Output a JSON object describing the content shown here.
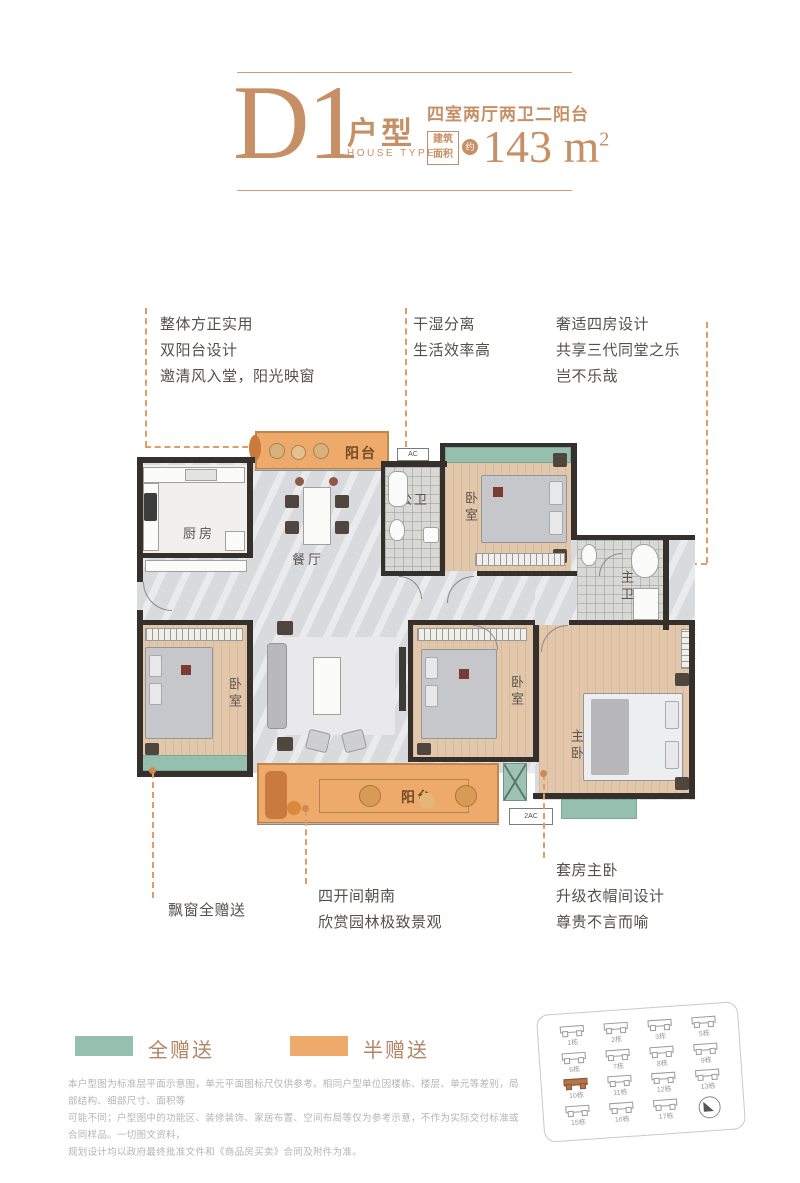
{
  "header": {
    "code": "D1",
    "type_label": "户型",
    "type_en": "HOUSE TYPE",
    "layout": "四室两厅两卫二阳台",
    "area_box_line1": "建筑",
    "area_box_line2": "面积",
    "area_circle": "约",
    "area_number": "143 m",
    "area_sup": "2",
    "accent_color": "#c68f65"
  },
  "callouts": {
    "top_left": [
      "整体方正实用",
      "双阳台设计",
      "邀清风入堂，阳光映窗"
    ],
    "top_mid": [
      "干湿分离",
      "生活效率高"
    ],
    "top_right": [
      "奢适四房设计",
      "共享三代同堂之乐",
      "岂不乐哉"
    ],
    "bottom_left": [
      "飘窗全赠送"
    ],
    "bottom_mid": [
      "四开间朝南",
      "欣赏园林极致景观"
    ],
    "bottom_right": [
      "套房主卧",
      "升级衣帽间设计",
      "尊贵不言而喻"
    ]
  },
  "rooms": {
    "kitchen": "厨房",
    "dining": "餐厅",
    "living": "客厅",
    "public_bath": "公卫",
    "master_bath": "主卫",
    "bedroom_top": "卧室",
    "bedroom_left": "卧室",
    "bedroom_mid": "卧室",
    "master_bedroom": "主卧",
    "cloakroom": "衣帽间",
    "balcony_top": "阳台",
    "balcony_bottom": "阳台",
    "ac_top": "AC",
    "ac_bottom": "2AC"
  },
  "legend": {
    "full_gift": {
      "label": "全赠送",
      "color": "#95bfae"
    },
    "half_gift": {
      "label": "半赠送",
      "color": "#edaa6b"
    }
  },
  "disclaimer": [
    "本户型图为标准层平面示意图，单元平面图标尺仅供参考。相同户型单位因楼栋、楼层、单元等差别，局部结构、细部尺寸、面积等",
    "可能不同；户型图中的功能区、装修装饰、家居布置、空间布局等仅为参考示意，不作为实际交付标准或合同样品。一切图文资料，",
    "规划设计均以政府最终批准文件和《商品房买卖》合同及附件为准。"
  ],
  "siteplan": {
    "buildings": [
      {
        "label": "1栋"
      },
      {
        "label": "2栋"
      },
      {
        "label": "3栋"
      },
      {
        "label": "5栋"
      },
      {
        "label": "6栋"
      },
      {
        "label": "7栋"
      },
      {
        "label": "8栋"
      },
      {
        "label": "9栋"
      },
      {
        "label": "10栋",
        "highlighted": true
      },
      {
        "label": "11栋"
      },
      {
        "label": "12栋"
      },
      {
        "label": "13栋"
      },
      {
        "label": "15栋"
      },
      {
        "label": "16栋"
      },
      {
        "label": "17栋"
      }
    ]
  },
  "colors": {
    "accent_tan": "#c68f65",
    "dash_orange": "#df9e63",
    "teal_full_gift": "#95bfae",
    "orange_half_gift": "#edaa6b",
    "wall": "#36302c"
  }
}
